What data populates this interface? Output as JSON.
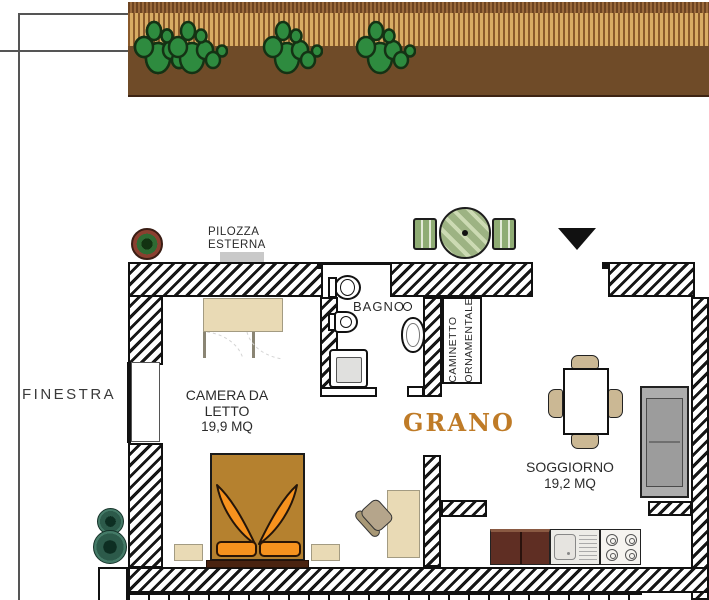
{
  "plan": {
    "name": "GRANO",
    "name_color": "#bf7b27",
    "type": "apartment floor plan"
  },
  "labels": {
    "finestra": "FINESTRA",
    "pilozza": [
      "PILOZZA",
      "ESTERNA"
    ],
    "bagno": "BAGNO",
    "caminetto": [
      "CAMINETTO",
      "ORNAMENTALE"
    ]
  },
  "rooms": {
    "camera_da_letto": {
      "name": [
        "CAMERA DA",
        "LETTO"
      ],
      "area": "19,9 MQ"
    },
    "soggiorno": {
      "name": "SOGGIORNO",
      "area": "19,2 MQ"
    }
  },
  "garden": {
    "plant_type": "cactus",
    "cactus_count": 6
  },
  "icons": {
    "entrance_marker": "black triangle pointing down",
    "outdoor_seating": "round striped table with two chairs",
    "plants_left": "two round bushes",
    "plant_top": "potted plant"
  },
  "colors": {
    "walls_hatch": "#161616",
    "soil": "#6f4b28",
    "slats": "#d8ac64",
    "bed": "#b5812f",
    "bed_accent": "#f6921e",
    "wood_furniture": "#e9dab5",
    "kitchen_cabinet": "#5f2e23",
    "sofa": "#adadad",
    "outdoor_table": "#9db383",
    "bush": "#2c5a4a"
  }
}
